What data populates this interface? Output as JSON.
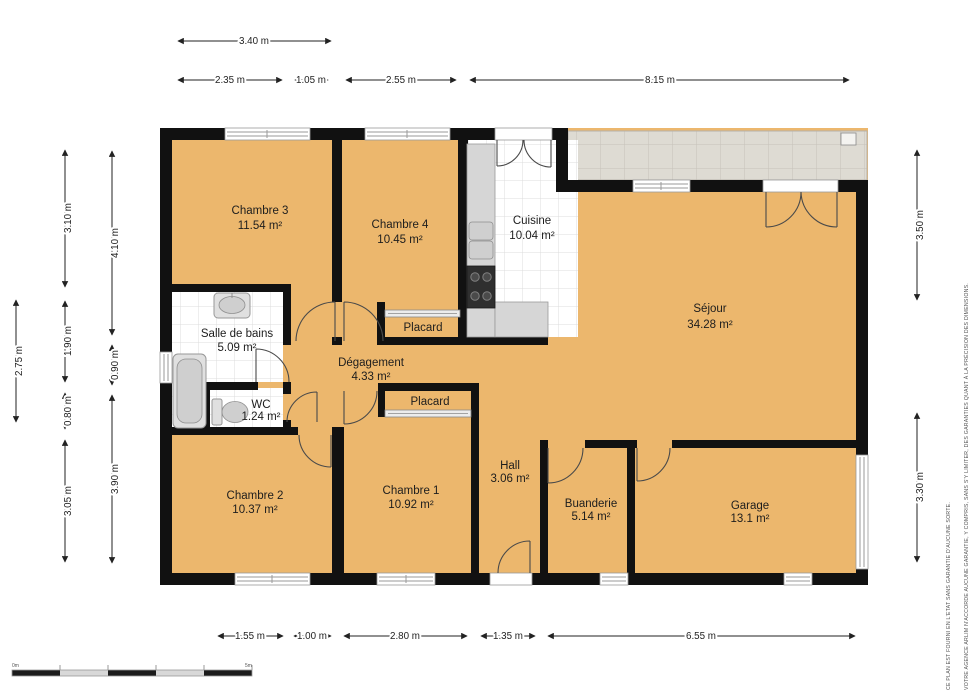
{
  "rooms": [
    {
      "id": "chambre-3",
      "name": "Chambre 3",
      "area": "11.54 m²"
    },
    {
      "id": "chambre-4",
      "name": "Chambre 4",
      "area": "10.45 m²"
    },
    {
      "id": "cuisine",
      "name": "Cuisine",
      "area": "10.04 m²"
    },
    {
      "id": "sejour",
      "name": "Séjour",
      "area": "34.28 m²"
    },
    {
      "id": "salle-de-bains",
      "name": "Salle de bains",
      "area": "5.09 m²"
    },
    {
      "id": "wc",
      "name": "WC",
      "area": "1.24 m²"
    },
    {
      "id": "degagement",
      "name": "Dégagement",
      "area": "4.33 m²"
    },
    {
      "id": "placard-haut",
      "name": "Placard",
      "area": ""
    },
    {
      "id": "placard-bas",
      "name": "Placard",
      "area": ""
    },
    {
      "id": "chambre-2",
      "name": "Chambre 2",
      "area": "10.37 m²"
    },
    {
      "id": "chambre-1",
      "name": "Chambre 1",
      "area": "10.92 m²"
    },
    {
      "id": "hall",
      "name": "Hall",
      "area": "3.06 m²"
    },
    {
      "id": "buanderie",
      "name": "Buanderie",
      "area": "5.14 m²"
    },
    {
      "id": "garage",
      "name": "Garage",
      "area": "13.1 m²"
    }
  ],
  "dimensions": {
    "top_row1": [
      "3.40 m"
    ],
    "top_row2": [
      "2.35 m",
      "1.05 m",
      "2.55 m",
      "8.15 m"
    ],
    "bottom": [
      "1.55 m",
      "1.00 m",
      "2.80 m",
      "1.35 m",
      "6.55 m"
    ],
    "left_outer": [
      "2.75 m"
    ],
    "left_mid": [
      "3.10 m",
      "1.90 m",
      "0.80 m",
      "3.05 m"
    ],
    "left_inner": [
      "4.10 m",
      "0.90 m",
      "3.90 m"
    ],
    "right": [
      "3.50 m",
      "3.30 m"
    ]
  },
  "disclaimer": {
    "line1": "CE PLAN EST FOURNI EN L'ETAT SANS GARANTIE D'AUCUNE SORTE.",
    "line2": "VOTRE AGENCE ARLIM N'ACCORDE AUCUNE GARANTIE, Y COMPRIS, SANS S'Y LIMITER, DES GARANTIES QUANT À LA PRÉCISION DES DIMENSIONS."
  },
  "scale_bar": {
    "start_label": "0m",
    "end_label": "5m"
  },
  "colors": {
    "floor": "#ecb76d",
    "wall": "#111111",
    "terrace": "#dedbd3",
    "tileline": "#dcdcdc",
    "dimcolor": "#222222"
  }
}
